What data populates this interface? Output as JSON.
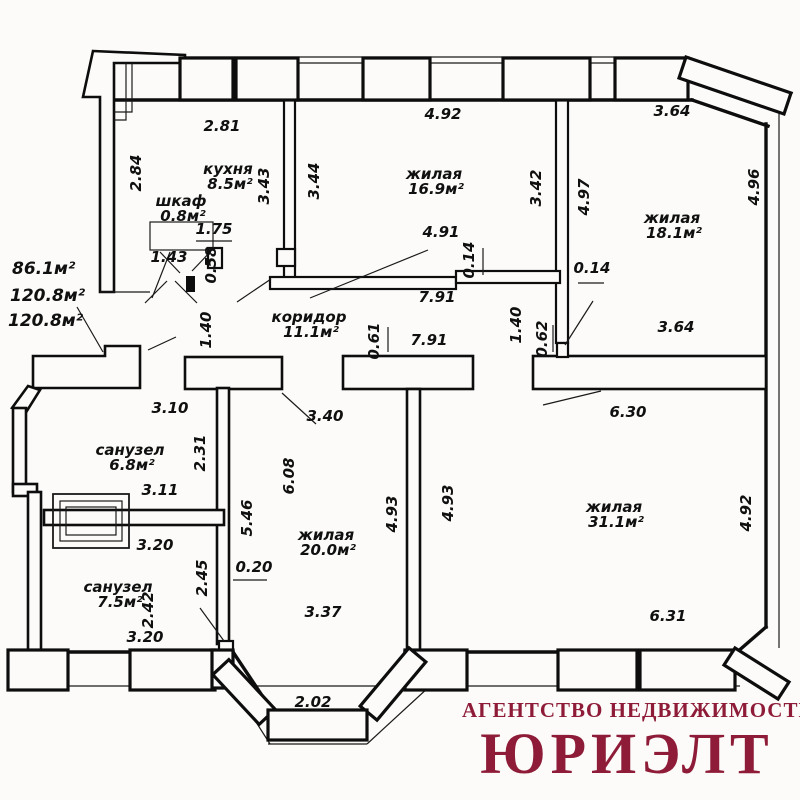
{
  "plan": {
    "totals": [
      {
        "t": "86.1м²",
        "x": 12,
        "y": 274
      },
      {
        "t": "120.8м²",
        "x": 10,
        "y": 301
      },
      {
        "t": "120.8м²",
        "x": 8,
        "y": 326
      }
    ],
    "rooms": [
      {
        "name": "кухня",
        "area": "8.5м²",
        "x": 228,
        "y": 174
      },
      {
        "name": "шкаф",
        "area": "0.8м²",
        "x": 181,
        "y": 206
      },
      {
        "name": "жилая",
        "area": "16.9м²",
        "x": 434,
        "y": 179
      },
      {
        "name": "жилая",
        "area": "18.1м²",
        "x": 672,
        "y": 223
      },
      {
        "name": "коридор",
        "area": "11.1м²",
        "x": 309,
        "y": 322
      },
      {
        "name": "санузел",
        "area": "6.8м²",
        "x": 130,
        "y": 455
      },
      {
        "name": "санузел",
        "area": "7.5м²",
        "x": 118,
        "y": 592
      },
      {
        "name": "жилая",
        "area": "20.0м²",
        "x": 326,
        "y": 540
      },
      {
        "name": "жилая",
        "area": "31.1м²",
        "x": 614,
        "y": 512
      }
    ],
    "dims": [
      {
        "t": "2.81",
        "x": 222,
        "y": 131,
        "r": 0
      },
      {
        "t": "2.84",
        "x": 141,
        "y": 173,
        "r": -90
      },
      {
        "t": "3.43",
        "x": 269,
        "y": 186,
        "r": -90
      },
      {
        "t": "3.44",
        "x": 319,
        "y": 181,
        "r": -90
      },
      {
        "t": "4.92",
        "x": 443,
        "y": 119,
        "r": 0
      },
      {
        "t": "3.42",
        "x": 541,
        "y": 188,
        "r": -90
      },
      {
        "t": "4.97",
        "x": 589,
        "y": 197,
        "r": -90
      },
      {
        "t": "3.64",
        "x": 672,
        "y": 116,
        "r": 0
      },
      {
        "t": "4.96",
        "x": 759,
        "y": 187,
        "r": -90
      },
      {
        "t": "1.75",
        "x": 214,
        "y": 234,
        "r": 0
      },
      {
        "t": "1.43",
        "x": 169,
        "y": 262,
        "r": 0
      },
      {
        "t": "0.58",
        "x": 216,
        "y": 265,
        "r": -90
      },
      {
        "t": "4.91",
        "x": 441,
        "y": 237,
        "r": 0
      },
      {
        "t": "0.14",
        "x": 474,
        "y": 260,
        "r": -90
      },
      {
        "t": "0.14",
        "x": 592,
        "y": 273,
        "r": 0
      },
      {
        "t": "7.91",
        "x": 437,
        "y": 302,
        "r": 0
      },
      {
        "t": "7.91",
        "x": 429,
        "y": 345,
        "r": 0
      },
      {
        "t": "1.40",
        "x": 211,
        "y": 330,
        "r": -90
      },
      {
        "t": "1.40",
        "x": 521,
        "y": 325,
        "r": -90
      },
      {
        "t": "0.61",
        "x": 379,
        "y": 341,
        "r": -90
      },
      {
        "t": "0.62",
        "x": 547,
        "y": 339,
        "r": -90
      },
      {
        "t": "3.64",
        "x": 676,
        "y": 332,
        "r": 0
      },
      {
        "t": "3.10",
        "x": 170,
        "y": 413,
        "r": 0
      },
      {
        "t": "2.31",
        "x": 205,
        "y": 453,
        "r": -90
      },
      {
        "t": "3.11",
        "x": 160,
        "y": 495,
        "r": 0
      },
      {
        "t": "5.46",
        "x": 252,
        "y": 518,
        "r": -90
      },
      {
        "t": "6.08",
        "x": 294,
        "y": 476,
        "r": -90
      },
      {
        "t": "3.40",
        "x": 325,
        "y": 421,
        "r": 0
      },
      {
        "t": "6.30",
        "x": 628,
        "y": 417,
        "r": 0
      },
      {
        "t": "3.20",
        "x": 155,
        "y": 550,
        "r": 0
      },
      {
        "t": "2.45",
        "x": 207,
        "y": 578,
        "r": -90
      },
      {
        "t": "0.20",
        "x": 254,
        "y": 572,
        "r": 0
      },
      {
        "t": "2.42",
        "x": 153,
        "y": 610,
        "r": -90
      },
      {
        "t": "3.20",
        "x": 145,
        "y": 642,
        "r": 0
      },
      {
        "t": "3.37",
        "x": 323,
        "y": 617,
        "r": 0
      },
      {
        "t": "4.93",
        "x": 397,
        "y": 514,
        "r": -90
      },
      {
        "t": "4.93",
        "x": 453,
        "y": 503,
        "r": -90
      },
      {
        "t": "6.31",
        "x": 668,
        "y": 621,
        "r": 0
      },
      {
        "t": "4.92",
        "x": 751,
        "y": 513,
        "r": -90
      },
      {
        "t": "2.02",
        "x": 313,
        "y": 707,
        "r": 0
      }
    ]
  },
  "logo": {
    "line1": "АГЕНТСТВО НЕДВИЖИМОСТИ",
    "line2": "ЮРИЭЛТ",
    "color": "#8e1c38"
  }
}
